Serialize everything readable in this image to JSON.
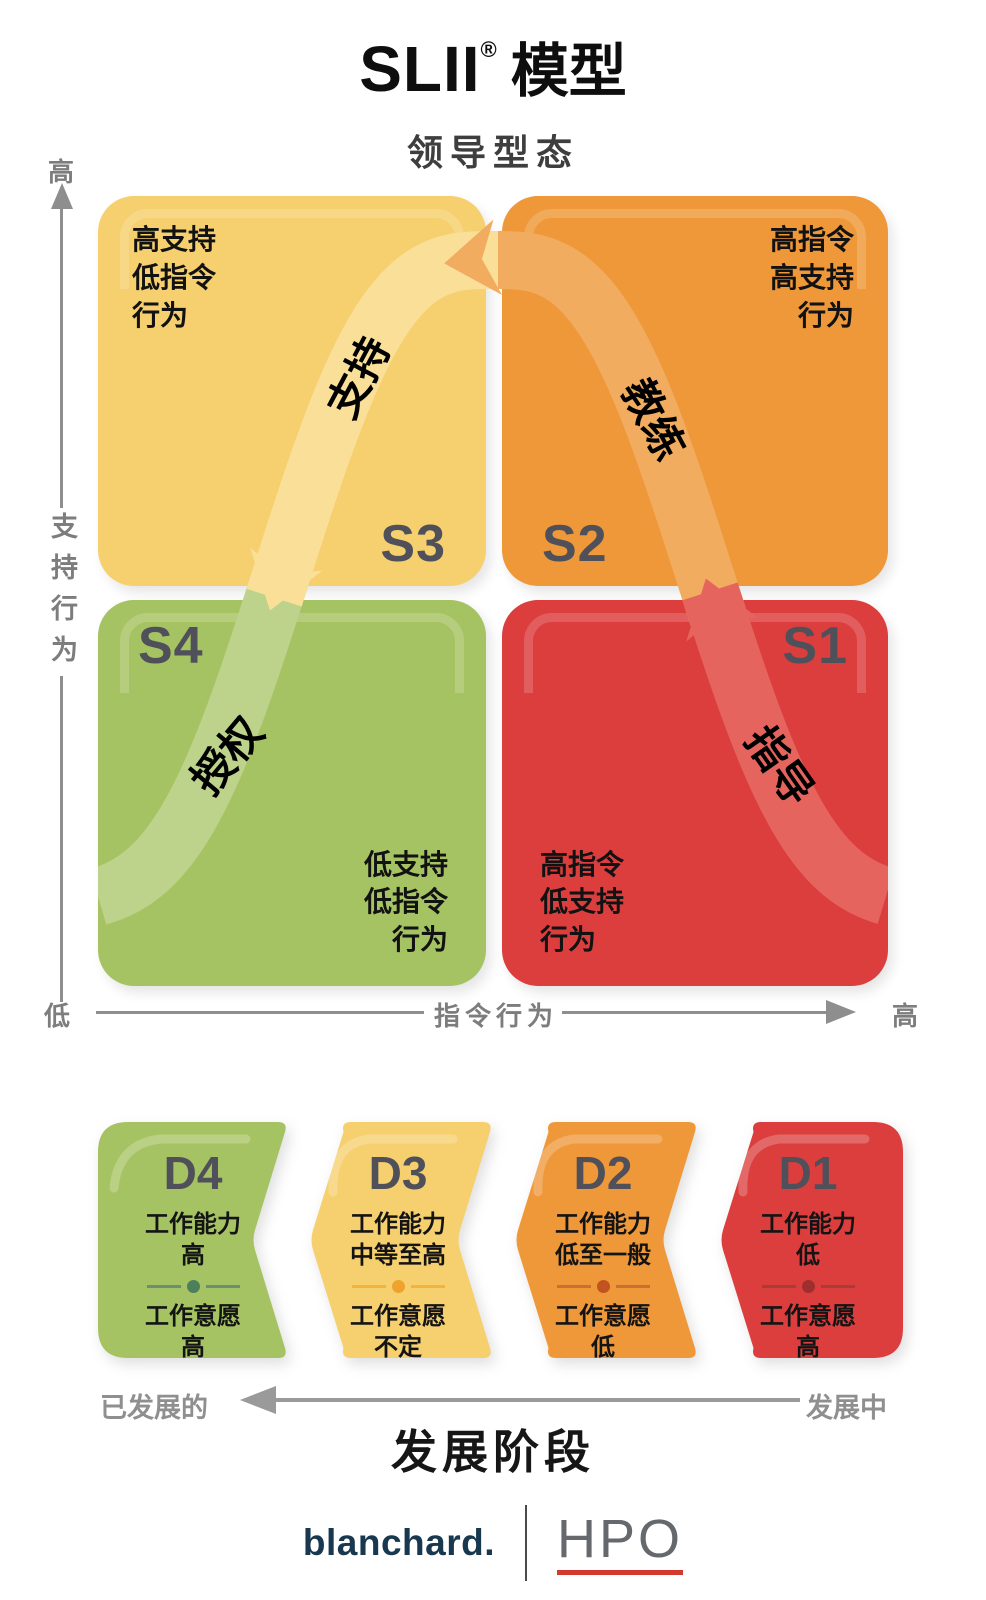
{
  "title": {
    "brand": "SLII",
    "reg": "®",
    "text": "模型"
  },
  "lead_title": "领导型态",
  "y_axis": {
    "top": "高",
    "label": "支持行为",
    "bottom": "低"
  },
  "x_axis": {
    "label": "指令行为",
    "right": "高"
  },
  "quadrants": [
    {
      "id": "S3",
      "lines": [
        "高支持",
        "低指令",
        "行为"
      ],
      "curve_label": "支持",
      "color": "#F6D06F",
      "band_color": "#F9DF98"
    },
    {
      "id": "S2",
      "lines": [
        "高指令",
        "高支持",
        "行为"
      ],
      "curve_label": "教练",
      "color": "#EE9839",
      "band_color": "#F1AC60"
    },
    {
      "id": "S4",
      "lines": [
        "低支持",
        "低指令",
        "行为"
      ],
      "curve_label": "授权",
      "color": "#A6C363",
      "band_color": "#BDD28B"
    },
    {
      "id": "S1",
      "lines": [
        "高指令",
        "低支持",
        "行为"
      ],
      "curve_label": "指导",
      "color": "#DC3E3E",
      "band_color": "#E5655E"
    }
  ],
  "dev_stages": [
    {
      "id": "D4",
      "competence_label": "工作能力",
      "competence": "高",
      "commitment_label": "工作意愿",
      "commitment": "高",
      "color": "#A6C363",
      "divider_color": "#6B8F72",
      "dot_color": "#4E7F5D"
    },
    {
      "id": "D3",
      "competence_label": "工作能力",
      "competence": "中等至高",
      "commitment_label": "工作意愿",
      "commitment": "不定",
      "color": "#F6D06F",
      "divider_color": "#F2B43F",
      "dot_color": "#EFA22D"
    },
    {
      "id": "D2",
      "competence_label": "工作能力",
      "competence": "低至一般",
      "commitment_label": "工作意愿",
      "commitment": "低",
      "color": "#EE9839",
      "divider_color": "#C96F34",
      "dot_color": "#C2521F"
    },
    {
      "id": "D1",
      "competence_label": "工作能力",
      "competence": "低",
      "commitment_label": "工作意愿",
      "commitment": "高",
      "color": "#DC3E3E",
      "divider_color": "#A83C38",
      "dot_color": "#9E2F2D"
    }
  ],
  "dev_axis": {
    "left": "已发展的",
    "right": "发展中"
  },
  "dev_heading": "发展阶段",
  "footer": {
    "brand": "blanchard.",
    "partner": "HPO",
    "underline_color": "#D23A2E"
  }
}
